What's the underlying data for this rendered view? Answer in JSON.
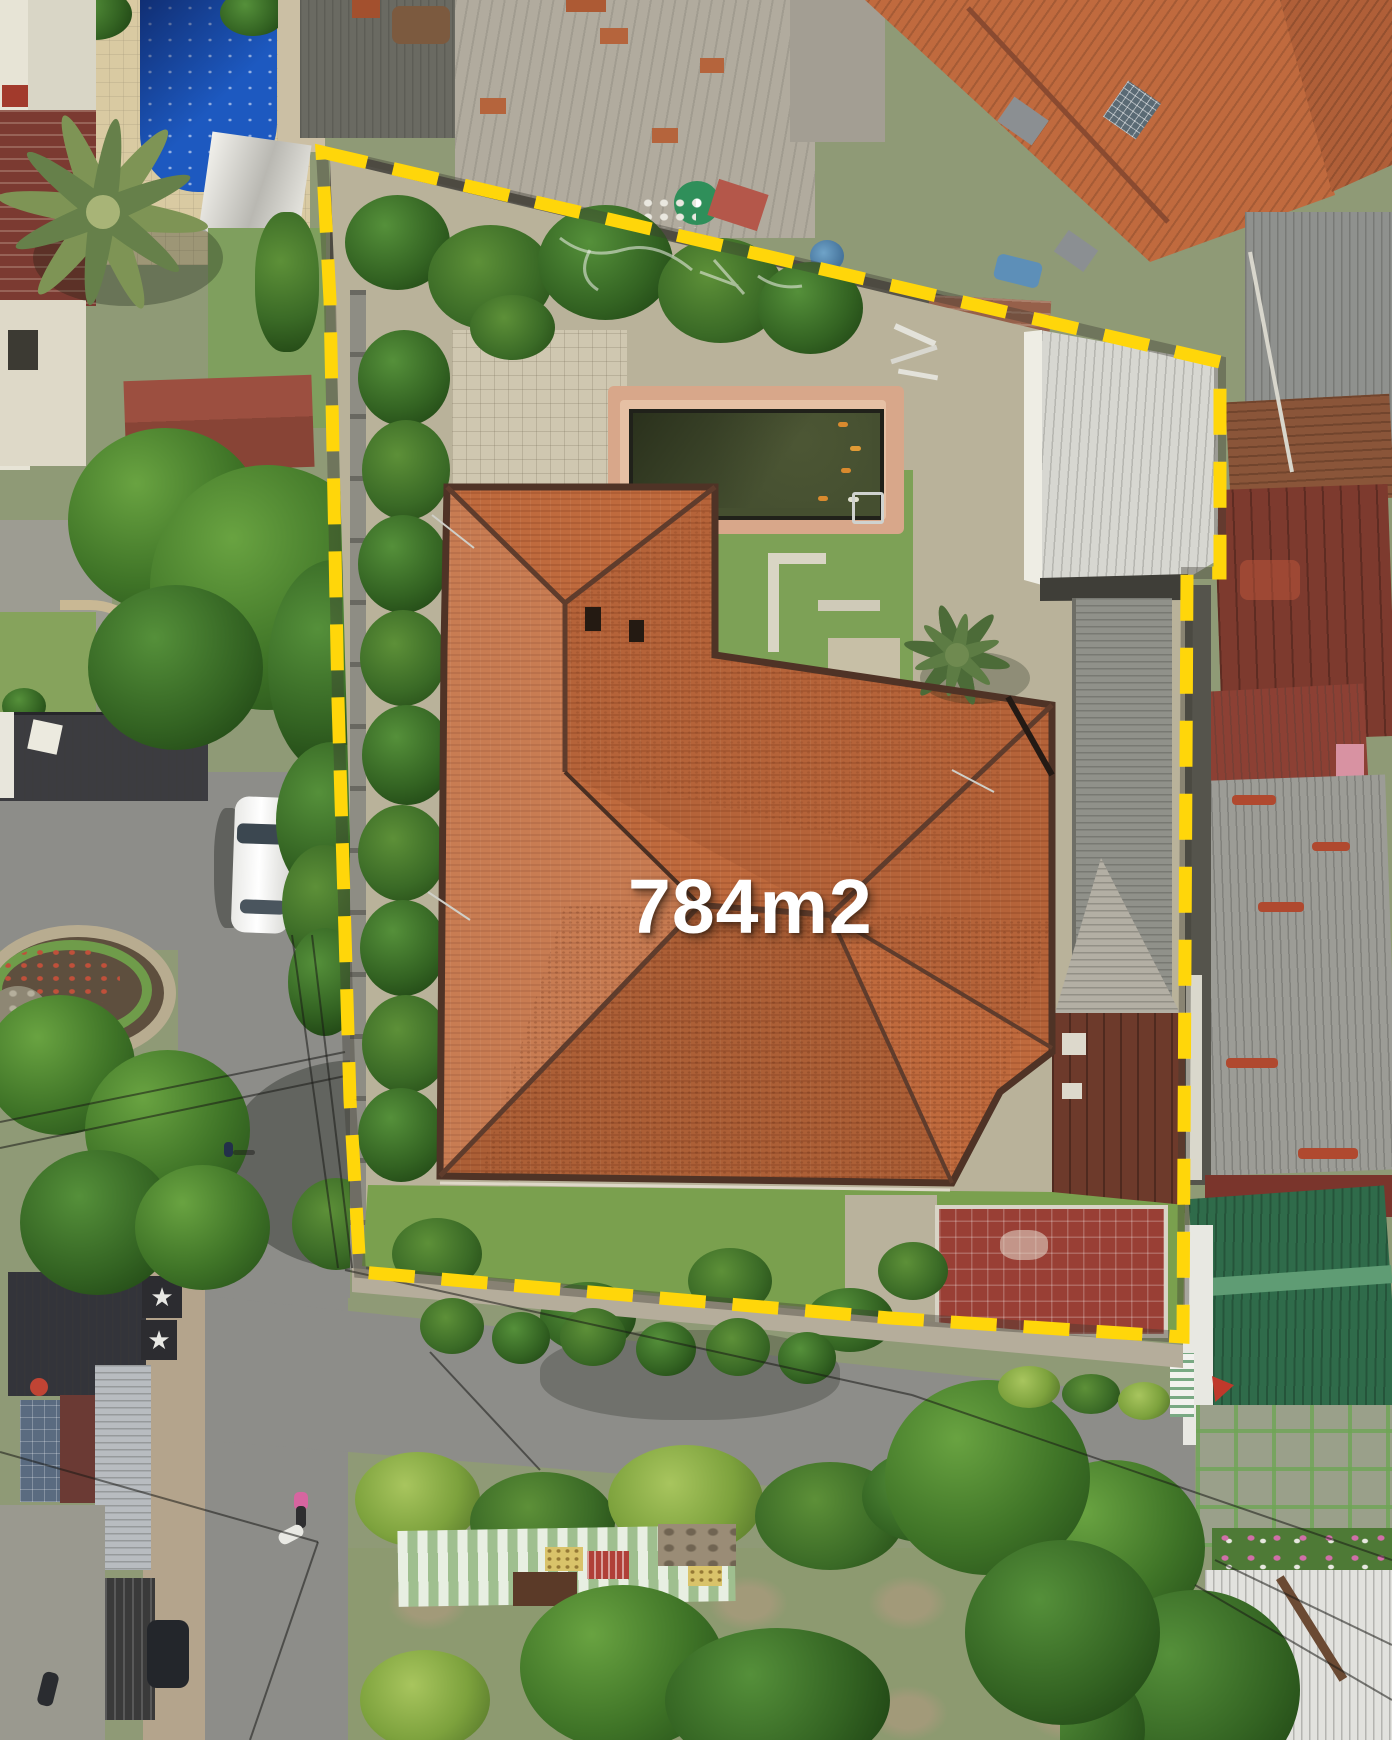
{
  "annotation": {
    "area_label": "784m2",
    "label_color": "#ffffff",
    "boundary_color": "#ffd60a",
    "boundary_gap_color": "#3c3a33",
    "boundary_style": "dashed",
    "boundary_points": [
      [
        322,
        152
      ],
      [
        1040,
        320
      ],
      [
        1220,
        362
      ],
      [
        1220,
        573
      ],
      [
        1187,
        573
      ],
      [
        1183,
        1337
      ],
      [
        890,
        1318
      ],
      [
        360,
        1272
      ],
      [
        350,
        1100
      ],
      [
        338,
        700
      ],
      [
        330,
        300
      ]
    ]
  },
  "decor": {
    "star_glyph": "★"
  },
  "palette": {
    "boundary_yellow": "#ffd60a",
    "main_roof_orange": "#bf6a3d",
    "neighbor_roof_orange": "#c06a3e",
    "pond_water_green": "#454f30",
    "pool_blue": "#1d59c0",
    "asphalt_grey": "#8d8d89",
    "white_metal_roof": "#d7d7d1",
    "green_metal_roof": "#2f6b4a",
    "maroon_roof": "#8c4034",
    "grass_green": "#7aa04e"
  }
}
